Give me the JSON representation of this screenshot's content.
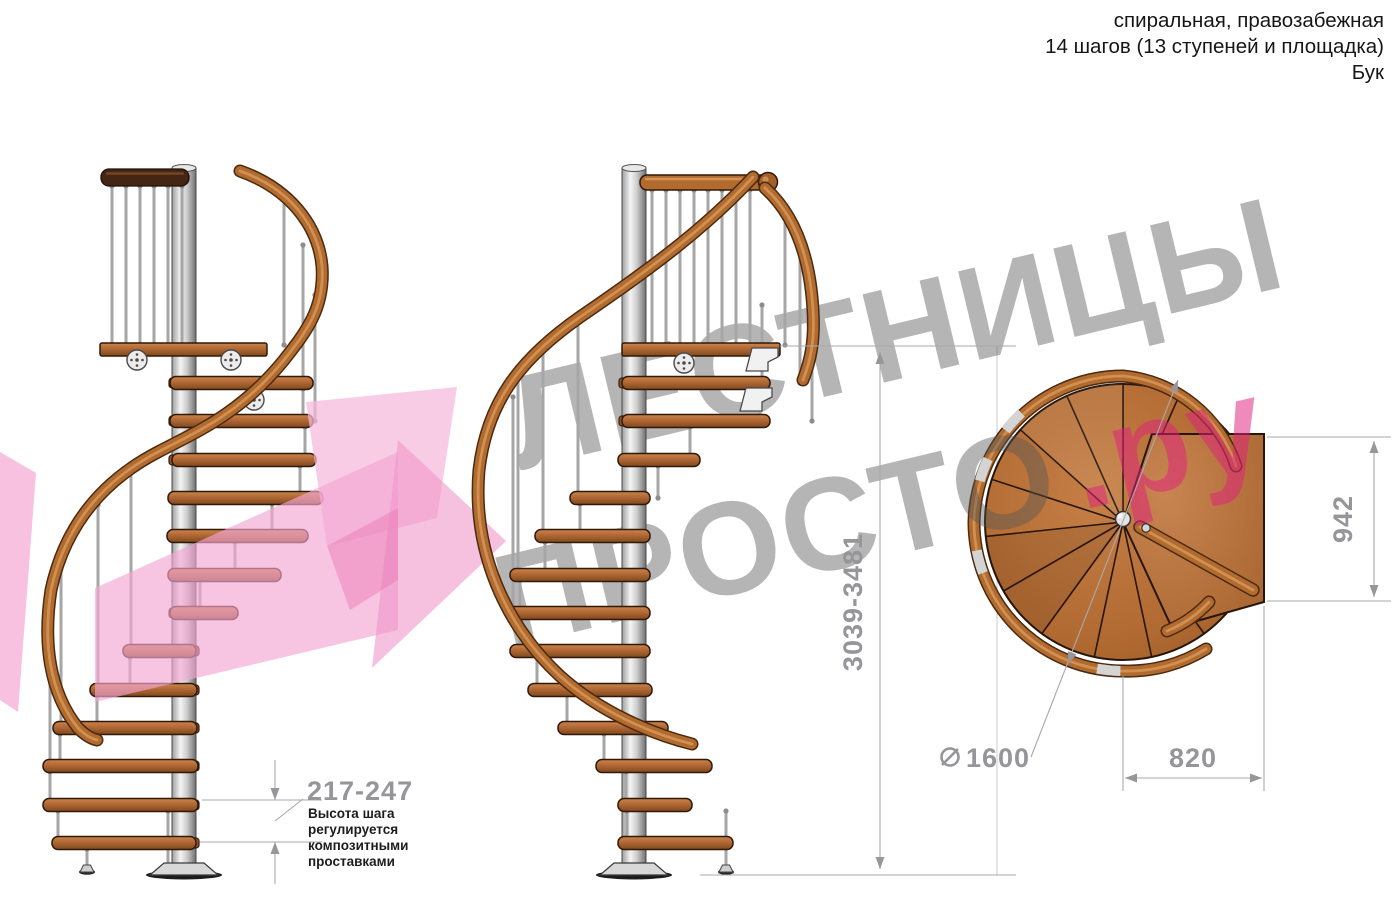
{
  "header": {
    "line1": "спиральная, правозабежная",
    "line2": "14 шагов (13 ступеней и площадка)",
    "line3": "Бук"
  },
  "watermark": {
    "word1": "ЛЕСТНИЦЫ",
    "word2": "ПРОСТО",
    "suffix": ".ру"
  },
  "dimensions": {
    "step_height": {
      "value": "217-247",
      "note": "Высота шага регулируется композитными проставками"
    },
    "total_height": {
      "value": "3039-3481"
    },
    "landing_width": {
      "value": "942"
    },
    "landing_offset": {
      "value": "820"
    },
    "diameter": {
      "symbol": "⌀",
      "value": "1600"
    }
  },
  "colors": {
    "wood": "#b16b2f",
    "wood_dark": "#4a2a11",
    "metal_column": "#cfcfcf",
    "dimension_gray": "#95959a",
    "watermark_gray": "#b5b5b5",
    "watermark_pink": "#ef8fbd",
    "arrow_pink": "#f3a6d2"
  }
}
